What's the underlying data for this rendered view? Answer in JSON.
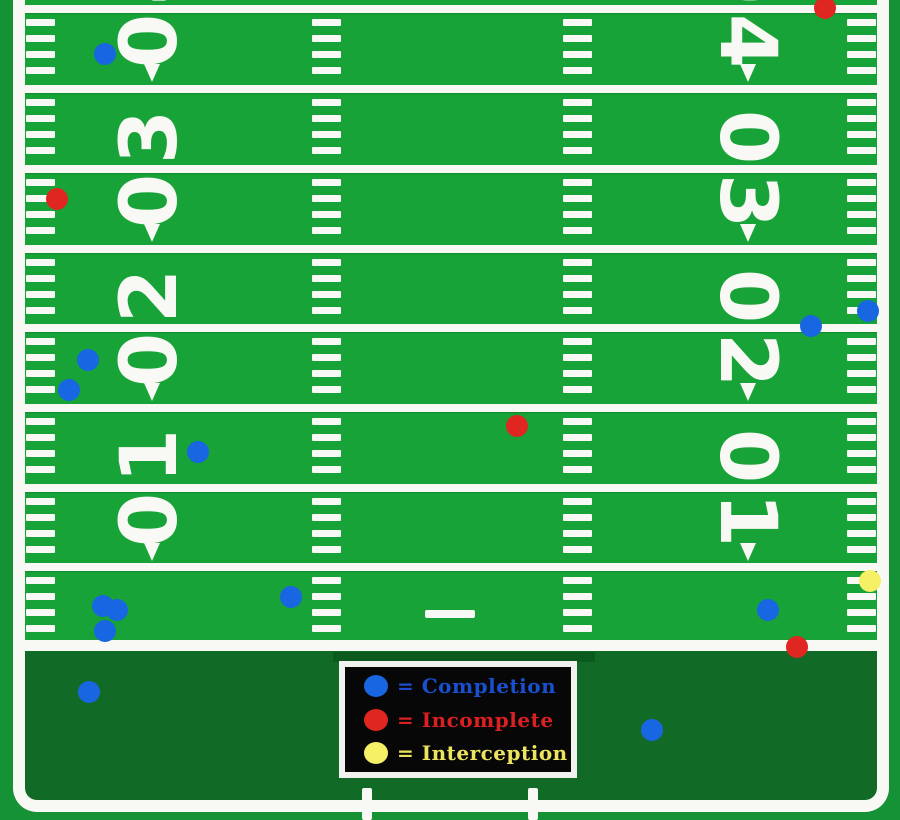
{
  "field": {
    "colors": {
      "grass": "#17a338",
      "end_zone": "#116b26",
      "outside": "#159136",
      "line": "#f8f8f4"
    },
    "yard_lines_y": [
      9,
      89,
      169,
      249,
      328,
      408,
      488,
      567
    ],
    "goal_line_y": 640,
    "yard_numbers": [
      {
        "label": "40",
        "line_y": 9
      },
      {
        "label": "30",
        "line_y": 169
      },
      {
        "label": "20",
        "line_y": 328
      },
      {
        "label": "10",
        "line_y": 488
      }
    ],
    "number_columns": {
      "left_x": 150,
      "right_x": 747
    },
    "arrow_columns": {
      "left_x": 152,
      "right_x": 748
    },
    "hash_columns_x": [
      26,
      312,
      563,
      847
    ],
    "hash_offsets_in_segment": [
      10,
      26,
      42,
      58
    ],
    "center_dash": {
      "x": 425,
      "y": 610,
      "w": 50,
      "h": 8
    },
    "bottom_ticks_x": [
      362,
      528
    ],
    "bottom_ticks_y": 788
  },
  "legend": {
    "background": "#070707",
    "border": "#f2f2ee",
    "items": [
      {
        "name": "completion",
        "swatch_color": "#1866e2",
        "text_color": "#1a4fd0",
        "label": "= Completion"
      },
      {
        "name": "incomplete",
        "swatch_color": "#e02621",
        "text_color": "#da2020",
        "label": "= Incomplete"
      },
      {
        "name": "interception",
        "swatch_color": "#f5f065",
        "text_color": "#ece45e",
        "label": "= Interception"
      }
    ]
  },
  "chart_data": {
    "type": "scatter",
    "description": "Football pass chart: pass outcome locations plotted on a vertical field; goal line at y_px 640, 16 px per yard, negative yards_to_goal = end zone.",
    "categories": [
      "Completion",
      "Incomplete",
      "Interception"
    ],
    "series": [
      {
        "name": "Completion",
        "color": "#1866e2",
        "points": [
          {
            "x": 105,
            "y": 54,
            "yards_to_goal": 36.6
          },
          {
            "x": 868,
            "y": 311,
            "yards_to_goal": 20.6
          },
          {
            "x": 811,
            "y": 326,
            "yards_to_goal": 19.6
          },
          {
            "x": 88,
            "y": 360,
            "yards_to_goal": 17.5
          },
          {
            "x": 69,
            "y": 390,
            "yards_to_goal": 15.6
          },
          {
            "x": 198,
            "y": 452,
            "yards_to_goal": 11.8
          },
          {
            "x": 291,
            "y": 597,
            "yards_to_goal": 2.7
          },
          {
            "x": 103,
            "y": 606,
            "yards_to_goal": 2.1
          },
          {
            "x": 117,
            "y": 610,
            "yards_to_goal": 1.9
          },
          {
            "x": 768,
            "y": 610,
            "yards_to_goal": 1.9
          },
          {
            "x": 105,
            "y": 631,
            "yards_to_goal": 0.6
          },
          {
            "x": 89,
            "y": 692,
            "yards_to_goal": -3.3
          },
          {
            "x": 652,
            "y": 730,
            "yards_to_goal": -5.6
          }
        ]
      },
      {
        "name": "Incomplete",
        "color": "#e02621",
        "points": [
          {
            "x": 825,
            "y": 8,
            "yards_to_goal": 39.5
          },
          {
            "x": 57,
            "y": 199,
            "yards_to_goal": 27.6
          },
          {
            "x": 517,
            "y": 426,
            "yards_to_goal": 13.4
          },
          {
            "x": 797,
            "y": 647,
            "yards_to_goal": -0.4
          }
        ]
      },
      {
        "name": "Interception",
        "color": "#f5f065",
        "points": [
          {
            "x": 870,
            "y": 581,
            "yards_to_goal": 3.7
          }
        ]
      }
    ],
    "legend_position": "bottom-center (inside end zone)",
    "grid": "yard lines every 5 yards (80 px), hash marks every yard (16 px)"
  }
}
